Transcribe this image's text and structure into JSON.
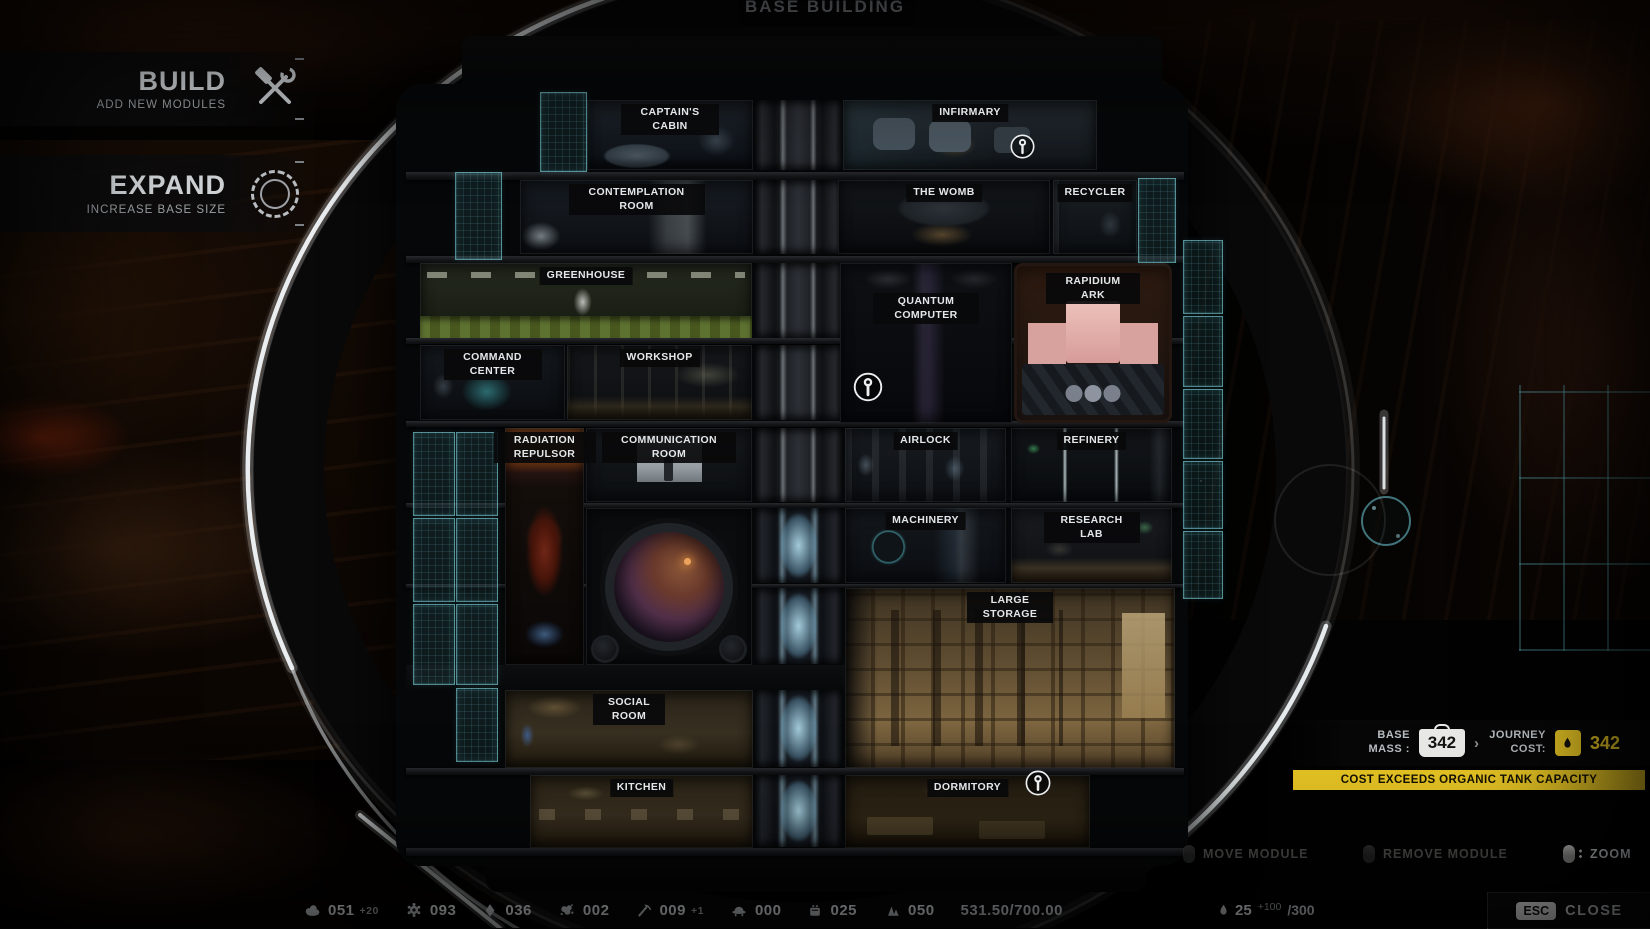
{
  "title": "BASE BUILDING",
  "left_menu": {
    "build": {
      "label": "BUILD",
      "sublabel": "ADD NEW MODULES",
      "icon": "hammer-wrench-icon"
    },
    "expand": {
      "label": "EXPAND",
      "sublabel": "INCREASE BASE SIZE",
      "icon": "segmented-ring-icon"
    }
  },
  "modules": {
    "captains_cabin": "CAPTAIN'S CABIN",
    "infirmary": "INFIRMARY",
    "contemplation_room": "CONTEMPLATION ROOM",
    "the_womb": "THE WOMB",
    "recycler": "RECYCLER",
    "greenhouse": "GREENHOUSE",
    "quantum_computer": "QUANTUM COMPUTER",
    "rapidium_ark": "RAPIDIUM ARK",
    "command_center": "COMMAND CENTER",
    "workshop": "WORKSHOP",
    "radiation_repulsor": "RADIATION REPULSOR",
    "communication_room": "COMMUNICATION ROOM",
    "airlock": "AIRLOCK",
    "refinery": "REFINERY",
    "machinery": "MACHINERY",
    "research_lab": "RESEARCH LAB",
    "large_storage": "LARGE STORAGE",
    "social_room": "SOCIAL ROOM",
    "kitchen": "KITCHEN",
    "dormitory": "DORMITORY"
  },
  "mass_panel": {
    "base_mass_label": "BASE MASS :",
    "base_mass_value": "342",
    "arrow": "›",
    "journey_cost_label": "JOURNEY COST:",
    "journey_cost_value": "342",
    "warning": "COST EXCEEDS ORGANIC TANK CAPACITY",
    "accent_color": "#e7c524"
  },
  "hints": {
    "move": "MOVE MODULE",
    "remove": "REMOVE MODULE",
    "zoom": "ZOOM"
  },
  "resources": [
    {
      "icon": "metal-scraps-icon",
      "value": "051",
      "bonus": "+20"
    },
    {
      "icon": "gear-icon",
      "value": "093",
      "bonus": ""
    },
    {
      "icon": "crystal-icon",
      "value": "036",
      "bonus": ""
    },
    {
      "icon": "organics-icon",
      "value": "002",
      "bonus": ""
    },
    {
      "icon": "pickaxe-icon",
      "value": "009",
      "bonus": "+1"
    },
    {
      "icon": "dome-icon",
      "value": "000",
      "bonus": ""
    },
    {
      "icon": "rations-icon",
      "value": "025",
      "bonus": ""
    },
    {
      "icon": "minerals-icon",
      "value": "050",
      "bonus": ""
    }
  ],
  "storage_capacity": "531.50/700.00",
  "organic_tank": {
    "icon": "drop-icon",
    "value": "25",
    "bonus": "+100",
    "capacity": "/300"
  },
  "close": {
    "key": "ESC",
    "label": "CLOSE"
  }
}
